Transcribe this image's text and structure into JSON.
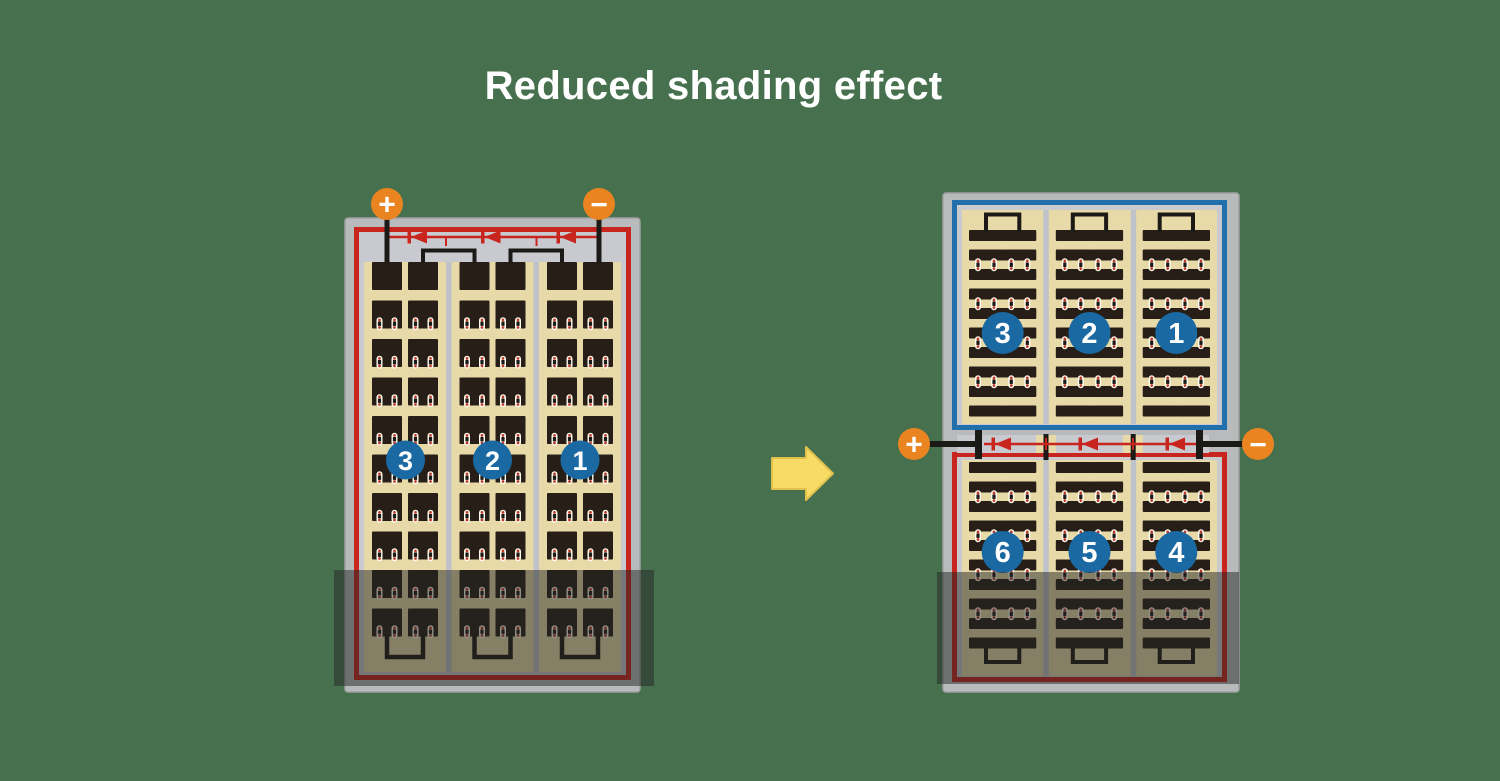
{
  "title": "Reduced shading effect",
  "colors": {
    "background": "#47704E",
    "title_text": "#FFFFFF",
    "frame_gray": "#B9BABC",
    "frame_edge": "#9FA0A2",
    "inner_gray": "#C8CAD0",
    "separator_gray": "#BFC3C9",
    "panel_tan": "#E7DAA8",
    "cell_dark": "#271F17",
    "wire_black": "#1C1A17",
    "string_red": "#C8251F",
    "string_blue": "#2170AC",
    "badge_blue": "#1A69A2",
    "badge_text": "#FFFFFF",
    "terminal_orange": "#E98420",
    "terminal_symbol": "#FFFFFF",
    "diode_red": "#C8251F",
    "dot_white": "#FFFDF0",
    "dot_red": "#C03A2B",
    "arrow_yellow": "#F7DB65",
    "arrow_outline": "#E0C14E",
    "shade": "rgba(35,35,33,0.50)"
  },
  "left_module": {
    "badges": [
      "3",
      "2",
      "1"
    ],
    "terminals": {
      "positive": "+",
      "negative": "−"
    }
  },
  "right_module": {
    "top_badges": [
      "3",
      "2",
      "1"
    ],
    "bottom_badges": [
      "6",
      "5",
      "4"
    ],
    "terminals": {
      "positive": "+",
      "negative": "−"
    }
  },
  "arrow": {
    "icon": "arrow-right"
  }
}
